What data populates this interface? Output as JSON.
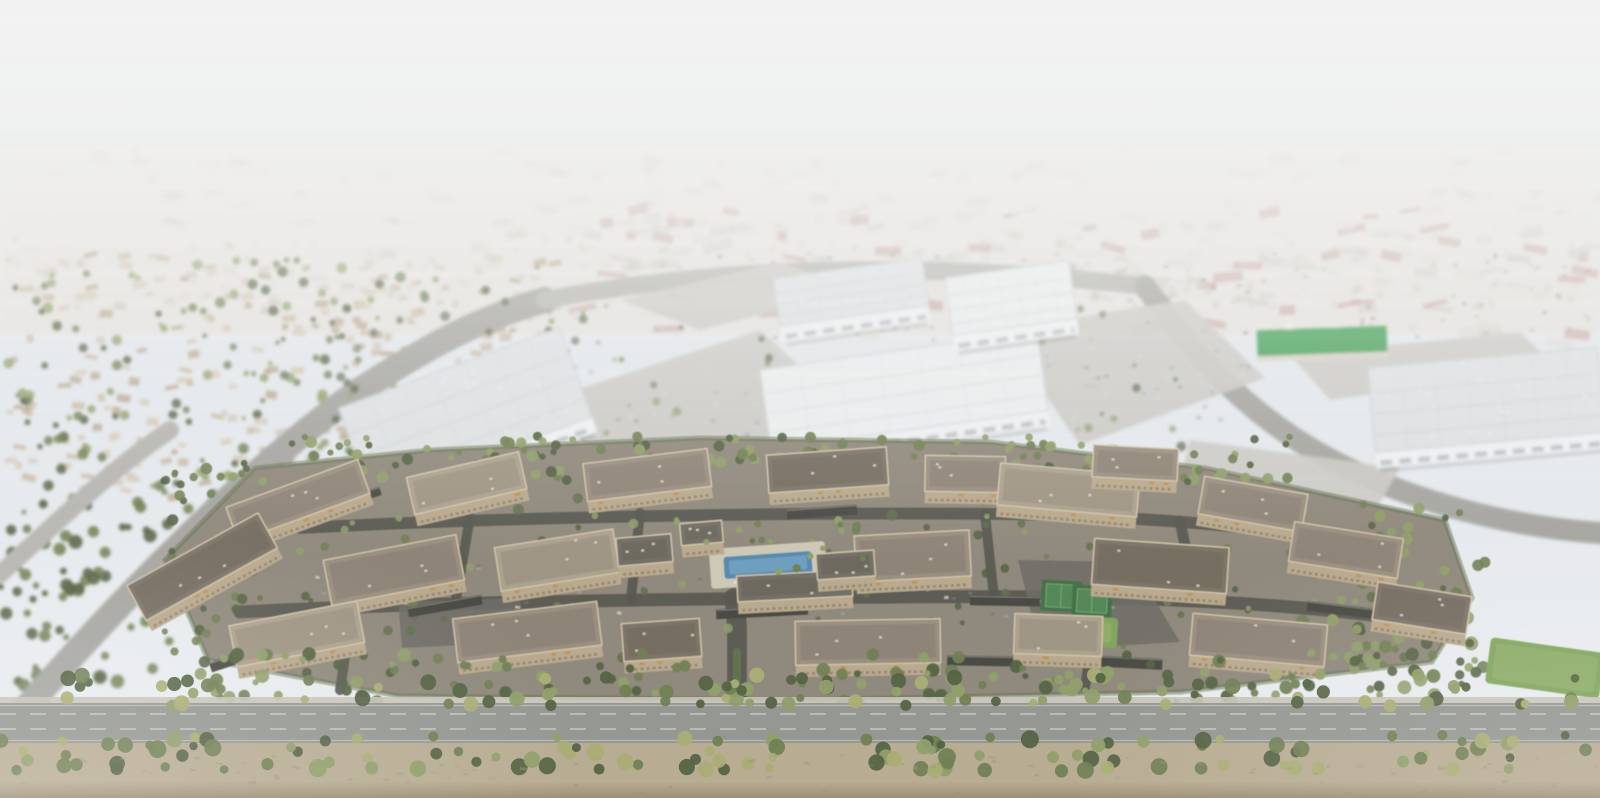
{
  "meta": {
    "description": "Hazy oblique aerial architectural rendering: a three-story tan garden-style apartment community with central pool courtyard, sport courts, carports and tree-lined entry drive in the foreground; white industrial warehouse buildings and commercial parking lots in the midground; a green-roofed building among retail lots; suburban rooftops and a vast valley cityscape fading into white haze; a tree-lined arterial road and dirt shoulder across the bottom.",
    "visible_text": "none",
    "width_px": 1600,
    "height_px": 798,
    "regions": {
      "background": "suburban valley cityscape dissolving into atmospheric haze",
      "midground": "white tilt-up warehouses, parking lots, curving arterial roads, green-roofed building",
      "foreground": "garden-style apartment complex with pool, courts, lawns and internal drives",
      "bottom": "double tree row, arterial road and bare dirt shoulder"
    }
  },
  "palette": {
    "white": "#ffffff",
    "sky_top": "#dde2e8",
    "sky_horizon": "#e9ecef",
    "haze_white": "#f3f3f2",
    "distant_base": "#e4e2de",
    "distant_block1": "#d9d4cc",
    "distant_block2": "#cfc9c0",
    "distant_block3": "#e1ddd6",
    "distant_block_dark": "#c3bdb3",
    "tree_far": "#a3a890",
    "suburb_roof1": "#c8b6a0",
    "suburb_roof2": "#b7a48d",
    "suburb_roof3": "#d5c7b4",
    "suburb_wall": "#cfc6b8",
    "comm1": "#d8d7d2",
    "comm2": "#cbcac4",
    "comm3": "#e2e1dd",
    "comm_red": "#c29a92",
    "car_dark": "#6e6f6b",
    "car_light": "#d6d6d2",
    "car_gray": "#9b9b97",
    "warehouse_wall": "#eef0f1",
    "warehouse_window": "#8e979c",
    "warehouse_roof": "#dde0e2",
    "warehouse_roof_bright": "#eaeced",
    "warehouse_ridge": "#c6cbce",
    "parking_light": "#c9c7c1",
    "road_mid": "#a2a19c",
    "road_faint": "#b3b2ad",
    "road_bottom": "#8f918c",
    "road_line": "#d6d7d3",
    "sidewalk": "#c3bfb2",
    "dirt": "#b4a78d",
    "dirt_dark": "#97896d",
    "dirt_speck": "#a2957a",
    "complex_ground": "#8a8274",
    "apt_wall": "#d9c8a6",
    "apt_wall_shadow": "#b5a487",
    "apt_window": "#6f6453",
    "apt_awning": "#c08a3c",
    "apt_roof": "#948879",
    "apt_roof_dark": "#766d60",
    "apt_roof_light": "#a89c89",
    "apt_parapet": "#cfc1a5",
    "club_roof": "#6b675e",
    "drive_dark": "#504f49",
    "drive_mid": "#66655f",
    "carport": "#413f3a",
    "carport_light": "#8b8880",
    "pool_water": "#4d84ac",
    "pool_light": "#82abc7",
    "pool_deck": "#cfc8b6",
    "court_green": "#4c8050",
    "court_light": "#6da566",
    "court_dark": "#3b6a41",
    "lawn": "#7ba155",
    "lawn_light": "#93b06b",
    "tree_dark": "#4c5b3a",
    "tree_mid": "#69794b",
    "tree_light": "#8a9a62",
    "tree_yellow": "#a4a96d",
    "hedge": "#5a6a44",
    "church_roof": "#3f9e52",
    "church_base": "#d8d2c6"
  },
  "scene": {
    "apartment_buildings": [
      [
        300,
        506,
        140,
        36,
        -20
      ],
      [
        468,
        489,
        115,
        38,
        -13
      ],
      [
        648,
        481,
        125,
        38,
        -7
      ],
      [
        828,
        476,
        120,
        38,
        -4
      ],
      [
        965,
        480,
        80,
        36,
        1
      ],
      [
        1068,
        496,
        140,
        42,
        5
      ],
      [
        1252,
        510,
        105,
        38,
        10
      ],
      [
        205,
        572,
        150,
        40,
        -29
      ],
      [
        395,
        576,
        135,
        46,
        -11
      ],
      [
        558,
        566,
        120,
        44,
        -9
      ],
      [
        913,
        562,
        115,
        46,
        -3
      ],
      [
        1160,
        572,
        135,
        46,
        4
      ],
      [
        1345,
        556,
        110,
        40,
        9
      ],
      [
        298,
        640,
        130,
        42,
        -11
      ],
      [
        528,
        638,
        145,
        44,
        -7
      ],
      [
        662,
        646,
        78,
        38,
        -4
      ],
      [
        868,
        648,
        145,
        44,
        -1
      ],
      [
        1058,
        641,
        88,
        40,
        2
      ],
      [
        1258,
        646,
        135,
        42,
        5
      ],
      [
        1421,
        614,
        95,
        38,
        9
      ],
      [
        1135,
        469,
        85,
        32,
        3
      ]
    ],
    "amenity_buildings": [
      [
        645,
        556,
        55,
        28,
        -5
      ],
      [
        795,
        592,
        115,
        26,
        -3
      ],
      [
        846,
        571,
        58,
        26,
        -4
      ],
      [
        702,
        539,
        42,
        22,
        -5
      ]
    ],
    "carports": [
      [
        445,
        606,
        75,
        10,
        -10
      ],
      [
        762,
        612,
        92,
        10,
        -3
      ],
      [
        1005,
        601,
        70,
        10,
        1
      ],
      [
        1115,
        662,
        95,
        11,
        3
      ],
      [
        240,
        658,
        62,
        10,
        -18
      ],
      [
        982,
        661,
        70,
        10,
        1
      ],
      [
        1342,
        610,
        70,
        10,
        7
      ],
      [
        352,
        500,
        60,
        9,
        -18
      ],
      [
        822,
        512,
        70,
        10,
        -4
      ]
    ],
    "pool": {
      "cx": 768,
      "cy": 565,
      "w": 88,
      "h": 22,
      "rot": -4
    },
    "courts": [
      [
        1061,
        596,
        30,
        23,
        3
      ],
      [
        1092,
        601,
        30,
        23,
        3
      ]
    ],
    "lawns": [
      [
        1545,
        668,
        115,
        46,
        8
      ],
      [
        1075,
        631,
        85,
        30,
        3
      ]
    ],
    "entry_median": [
      733,
      648,
      8,
      44
    ],
    "warehouses": [
      [
        468,
        420,
        235,
        95,
        -20,
        "warehouse_roof"
      ],
      [
        905,
        398,
        280,
        80,
        -8,
        "warehouse_roof_bright"
      ],
      [
        852,
        300,
        150,
        48,
        -8,
        "warehouse_roof"
      ],
      [
        1012,
        306,
        125,
        58,
        -8,
        "warehouse_roof_bright"
      ],
      [
        1487,
        408,
        230,
        85,
        -5,
        "warehouse_roof"
      ]
    ],
    "church": {
      "cx": 1322,
      "cy": 341,
      "w": 130,
      "h": 26,
      "rot": -2
    },
    "parking_lots": [
      "M545,400 L760,330 L870,430 L640,505 Z",
      "M1000,330 L1185,300 L1265,378 L1080,445 Z",
      "M1290,355 L1520,332 L1558,368 L1330,400 Z",
      "M620,300 L780,262 L858,290 L700,330 Z",
      "M1190,440 L1400,468 L1372,516 L1180,482 Z"
    ],
    "roads": {
      "left_diagonal": "M28,706 C120,600 250,468 360,390 C432,344 480,318 545,300",
      "top_connector": "M545,300 C700,270 900,258 1145,286",
      "right_curve": "M1145,286 C1190,350 1245,415 1335,462 C1430,510 1530,528 1600,533",
      "left_edge": "M0,574 C60,520 110,470 170,430"
    },
    "complex_base": "M165,560 L255,468 L430,450 L700,438 L990,442 L1205,468 L1445,520 L1472,598 L1432,662 L1180,692 L800,700 L398,696 L208,660 Z",
    "drives": [
      [
        "M737,702 L737,640 C737,618 736,608 734,598",
        20
      ],
      [
        "M240,612 C450,601 700,599 900,597 C1100,595 1250,600 1380,616",
        13
      ],
      [
        "M300,528 C500,517 800,512 1000,514 C1150,516 1280,528 1400,548",
        12
      ],
      [
        "M470,517 L456,599",
        10
      ],
      [
        "M640,513 L631,599",
        10
      ],
      [
        "M985,514 L994,597",
        10
      ],
      [
        "M1180,521 L1196,599",
        11
      ],
      [
        "M340,690 L346,650",
        10
      ],
      [
        "M1085,688 L1090,652",
        10
      ]
    ],
    "lot_polygons": [
      "M1018,560 L1132,562 L1180,642 L1040,650 Z",
      "M398,602 L520,598 L526,642 L402,648 Z"
    ],
    "scatter_zones": [
      {
        "n": "distant-block",
        "p": "distant-scatter",
        "s": "rect",
        "c": 220,
        "x": 0,
        "y": 148,
        "w": 1600,
        "h": 150,
        "w1": 6,
        "w2": 24,
        "h1": 3,
        "h2": 8,
        "cols": [
          "distant_block1",
          "distant_block2",
          "distant_block3",
          "distant_block_dark"
        ],
        "o": 0.55
      },
      {
        "n": "distant-tree",
        "p": "distant-scatter",
        "s": "circle",
        "c": 130,
        "x": 0,
        "y": 238,
        "w": 1600,
        "h": 72,
        "r1": 1.5,
        "r2": 3.5,
        "cols": [
          "tree_far"
        ],
        "o": 0.45
      },
      {
        "n": "suburb-roof",
        "p": "suburb-scatter",
        "s": "rect",
        "c": 260,
        "x": 0,
        "y": 252,
        "w": 560,
        "h": 245,
        "w1": 6,
        "w2": 14,
        "h1": 4,
        "h2": 8,
        "cols": [
          "suburb_roof1",
          "suburb_roof2",
          "suburb_roof3",
          "suburb_wall"
        ],
        "o": 0.85
      },
      {
        "n": "suburb-tree",
        "p": "suburb-scatter",
        "s": "circle",
        "c": 200,
        "x": 0,
        "y": 258,
        "w": 560,
        "h": 255,
        "r1": 2,
        "r2": 5.5,
        "cols": [
          "tree_dark",
          "tree_mid",
          "tree_light"
        ],
        "o": 0.85
      },
      {
        "n": "left-lower-tree",
        "p": "suburb-scatter",
        "s": "circle",
        "c": 70,
        "x": 0,
        "y": 500,
        "w": 175,
        "h": 185,
        "r1": 3,
        "r2": 7,
        "cols": [
          "tree_dark",
          "tree_mid"
        ],
        "o": 0.9
      },
      {
        "n": "commercial-block",
        "p": "commercial-scatter",
        "s": "rect",
        "c": 200,
        "x": 560,
        "y": 205,
        "w": 1040,
        "h": 132,
        "w1": 8,
        "w2": 30,
        "h1": 4,
        "h2": 10,
        "cols": [
          "comm1",
          "comm2",
          "comm3",
          "comm_red"
        ],
        "o": 0.6
      },
      {
        "n": "commercial-car",
        "p": "commercial-scatter",
        "s": "rect",
        "c": 150,
        "x": 600,
        "y": 252,
        "w": 1000,
        "h": 88,
        "w1": 3,
        "w2": 5,
        "h1": 2,
        "h2": 3,
        "cols": [
          "car_dark",
          "car_light",
          "car_gray"
        ],
        "o": 0.55
      },
      {
        "n": "lot-a-car",
        "p": "lot-cars-scatter",
        "s": "rect",
        "c": 55,
        "x": 570,
        "y": 355,
        "w": 280,
        "h": 115,
        "w1": 3.5,
        "w2": 5,
        "h1": 2,
        "h2": 3,
        "cols": [
          "car_dark",
          "car_light",
          "car_gray"
        ],
        "o": 0.6
      },
      {
        "n": "lot-b-car",
        "p": "lot-cars-scatter",
        "s": "rect",
        "c": 50,
        "x": 1005,
        "y": 305,
        "w": 250,
        "h": 125,
        "w1": 3.5,
        "w2": 5,
        "h1": 2,
        "h2": 3,
        "cols": [
          "car_dark",
          "car_light",
          "car_gray"
        ],
        "o": 0.6
      },
      {
        "n": "mid-tree",
        "p": "mid-trees-scatter",
        "s": "circle",
        "c": 110,
        "x": 280,
        "y": 300,
        "w": 940,
        "h": 215,
        "r1": 2,
        "r2": 5,
        "cols": [
          "tree_dark",
          "tree_mid",
          "tree_light"
        ],
        "o": 0.7
      },
      {
        "n": "complex-back-tree",
        "p": "fore-back-trees",
        "s": "circle",
        "c": 150,
        "x": 230,
        "y": 436,
        "w": 1060,
        "h": 46,
        "r1": 3,
        "r2": 6,
        "cols": [
          "tree_dark",
          "tree_mid",
          "tree_light"
        ],
        "o": 0.95
      },
      {
        "n": "complex-inner-tree",
        "p": "fore-back-trees",
        "s": "circle",
        "c": 120,
        "x": 250,
        "y": 498,
        "w": 1160,
        "h": 165,
        "r1": 2.5,
        "r2": 5.5,
        "cols": [
          "tree_dark",
          "tree_mid",
          "tree_light",
          "hedge"
        ],
        "o": 0.85
      },
      {
        "n": "complex-left-tree",
        "p": "fore-back-trees",
        "s": "circle",
        "c": 40,
        "x": 158,
        "y": 468,
        "w": 95,
        "h": 205,
        "r1": 3,
        "r2": 6,
        "cols": [
          "tree_dark",
          "tree_mid"
        ],
        "o": 0.9
      },
      {
        "n": "complex-right-tree",
        "p": "fore-back-trees",
        "s": "circle",
        "c": 60,
        "x": 1290,
        "y": 498,
        "w": 195,
        "h": 195,
        "r1": 3,
        "r2": 7,
        "cols": [
          "tree_dark",
          "tree_mid",
          "tree_light"
        ],
        "o": 0.9
      },
      {
        "n": "complex-car",
        "p": "complex-cars-scatter",
        "s": "rect",
        "c": 45,
        "x": 300,
        "y": 560,
        "w": 900,
        "h": 56,
        "w1": 4,
        "w2": 5,
        "h1": 2.5,
        "h2": 3,
        "cols": [
          "car_dark",
          "car_light",
          "car_gray"
        ],
        "o": 0.7
      },
      {
        "n": "complex-front-tree-west",
        "p": "fore-front-trees",
        "s": "circle",
        "c": 55,
        "x": 200,
        "y": 652,
        "w": 490,
        "h": 50,
        "r1": 3,
        "r2": 7,
        "cols": [
          "tree_dark",
          "tree_mid",
          "tree_light"
        ],
        "o": 0.95
      },
      {
        "n": "complex-front-tree-east",
        "p": "fore-front-trees",
        "s": "circle",
        "c": 60,
        "x": 790,
        "y": 652,
        "w": 660,
        "h": 50,
        "r1": 3,
        "r2": 7,
        "cols": [
          "tree_dark",
          "tree_mid",
          "tree_light"
        ],
        "o": 0.95
      },
      {
        "n": "pool-palm",
        "p": "fore-front-trees",
        "s": "circle",
        "c": 16,
        "x": 665,
        "y": 520,
        "w": 200,
        "h": 58,
        "r1": 2.5,
        "r2": 4.5,
        "cols": [
          "tree_light",
          "tree_mid"
        ],
        "o": 1
      },
      {
        "n": "frontage-tree-upper",
        "p": "trees-row-top",
        "s": "circle",
        "c": 95,
        "x": 0,
        "y": 674,
        "w": 1600,
        "h": 32,
        "r1": 4,
        "r2": 8,
        "cols": [
          "tree_mid",
          "tree_dark",
          "tree_yellow",
          "tree_light"
        ],
        "o": 0.95
      },
      {
        "n": "frontage-tree-lower",
        "p": "trees-row-bottom",
        "s": "circle",
        "c": 120,
        "x": 0,
        "y": 735,
        "w": 1600,
        "h": 36,
        "r1": 4,
        "r2": 9,
        "cols": [
          "tree_mid",
          "tree_dark",
          "tree_yellow",
          "tree_light"
        ],
        "o": 0.95
      },
      {
        "n": "dirt-speck",
        "p": "dirt-scatter",
        "s": "rect",
        "c": 90,
        "x": 0,
        "y": 752,
        "w": 1600,
        "h": 42,
        "w1": 3,
        "w2": 8,
        "h1": 1.5,
        "h2": 3,
        "cols": [
          "dirt_dark",
          "dirt_speck"
        ],
        "o": 0.4
      }
    ]
  }
}
